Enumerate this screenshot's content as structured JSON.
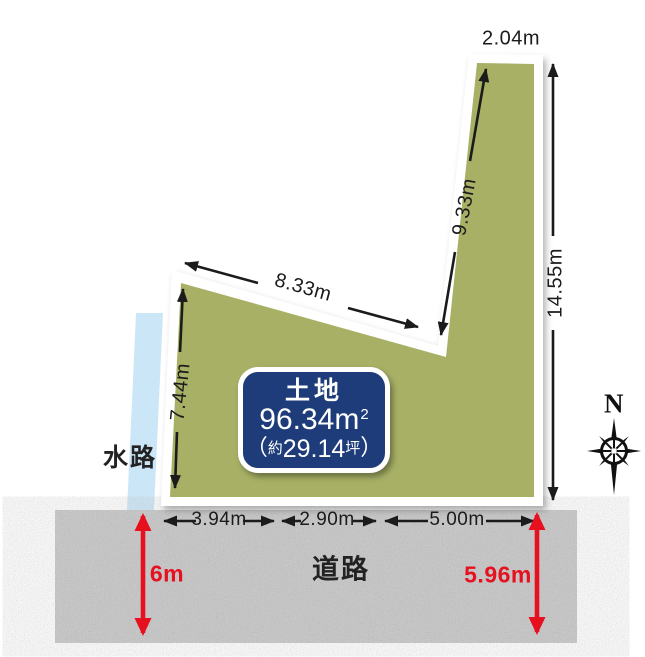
{
  "diagram": {
    "type": "land-plot-site-plan",
    "background": "#ffffff"
  },
  "parcel": {
    "fill": "#a7b065",
    "border_color": "#ffffff",
    "card": {
      "bg": "#1e3c7a",
      "title": "土地",
      "area_value": "96.34",
      "area_unit": "m",
      "area_sup": "2",
      "paren_open": "（",
      "approx_prefix": "約",
      "tsubo_value": "29.14",
      "tsubo_unit": "坪",
      "paren_close": "）"
    }
  },
  "dims": {
    "top": "2.04m",
    "right": "14.55m",
    "strip": "9.33m",
    "diag": "8.33m",
    "left": "7.44m",
    "front_a": "3.94m",
    "front_b": "2.90m",
    "front_c": "5.00m"
  },
  "waterway": {
    "label": "水路",
    "fill": "#cbe7f7"
  },
  "road": {
    "label": "道路",
    "fill": "#c6c6c6",
    "left_width": "6m",
    "right_width": "5.96m",
    "accent": "#e6101f"
  },
  "compass": {
    "north": "N"
  }
}
